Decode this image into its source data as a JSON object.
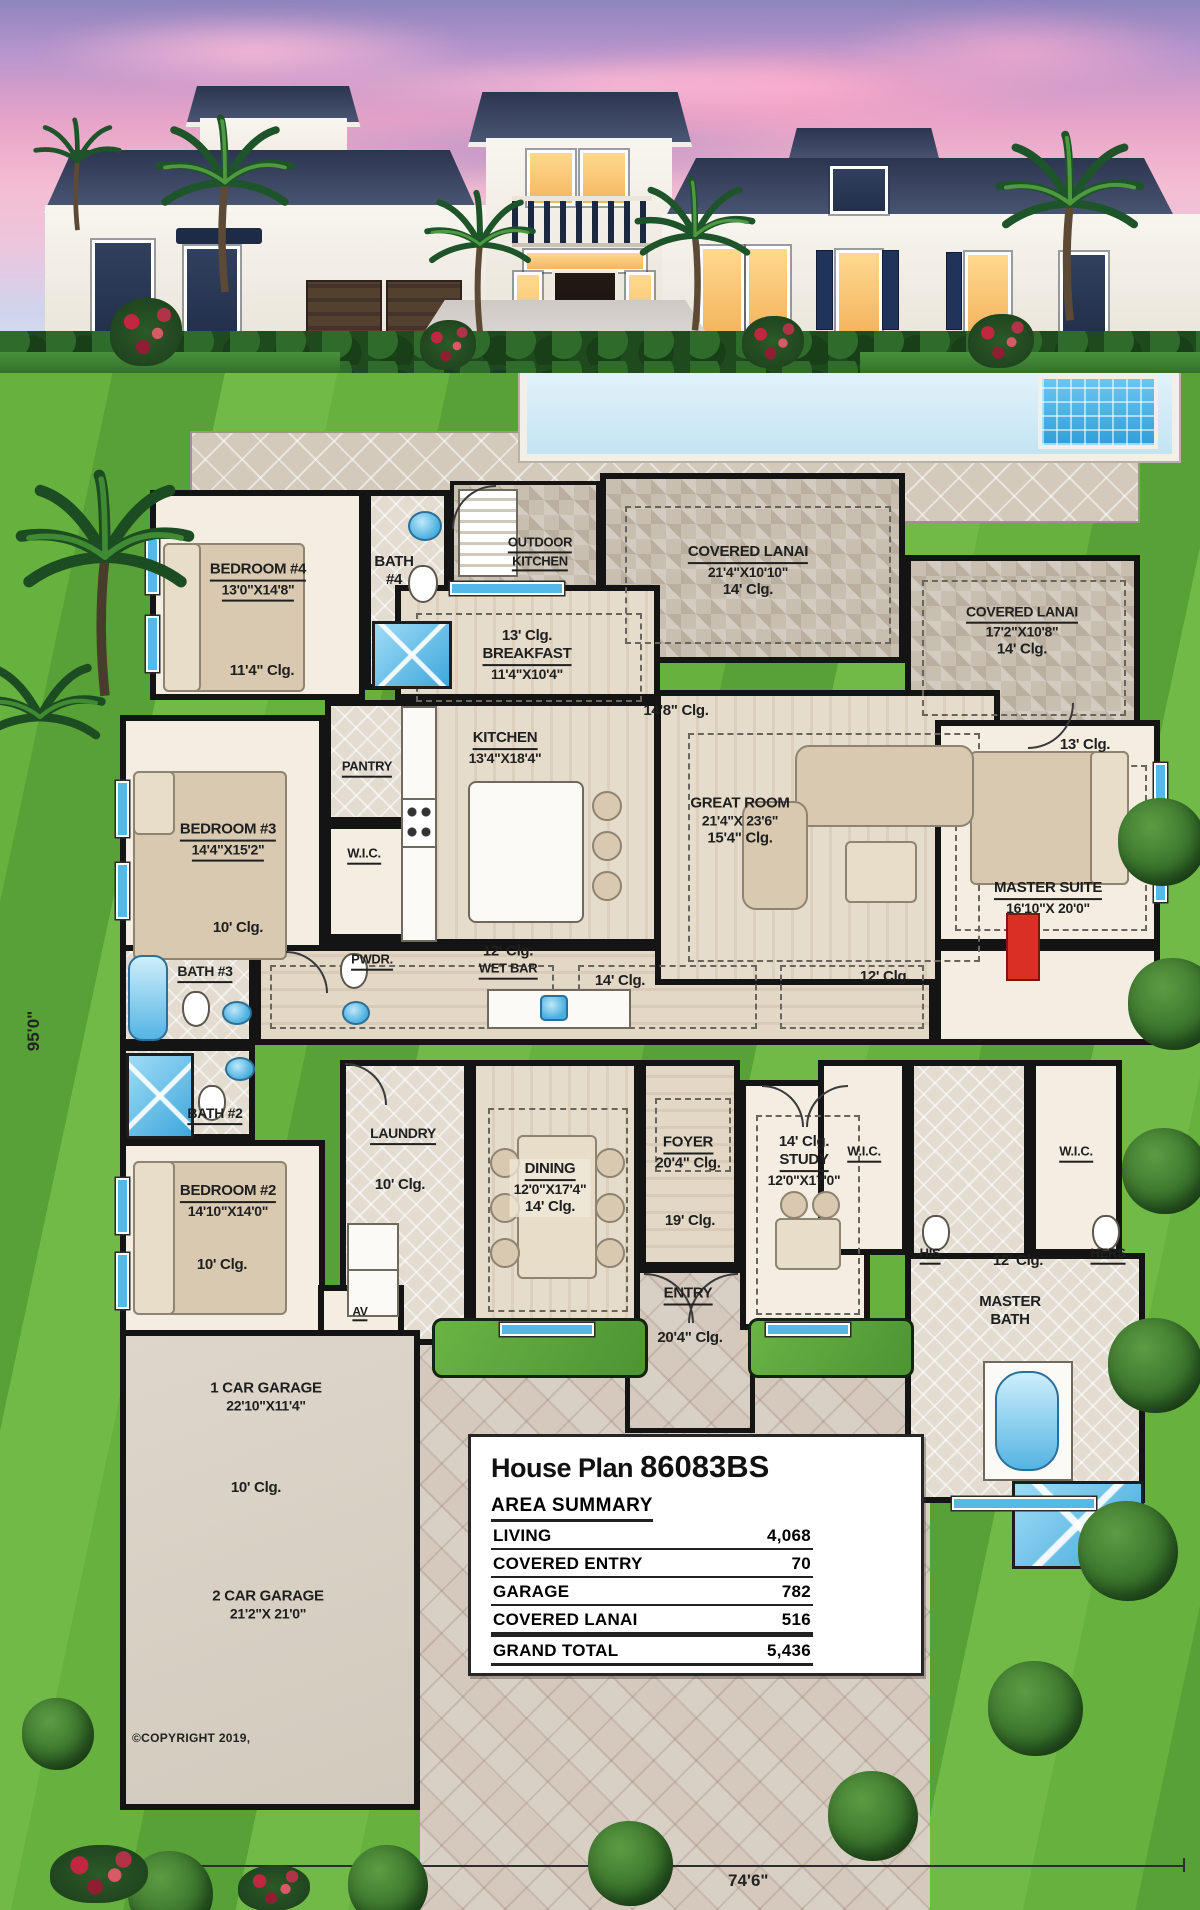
{
  "plan": {
    "dim_left": "95'0\"",
    "dim_bottom": "74'6\"",
    "copyright": "©COPYRIGHT 2019,",
    "rooms": {
      "bedroom4": {
        "name": "BEDROOM #4",
        "size": "13'0\"X14'8\"",
        "clg": "11'4\" Clg."
      },
      "bath4": {
        "l1": "BATH",
        "l2": "#4"
      },
      "outdoor_kitchen": {
        "l1": "OUTDOOR",
        "l2": "KITCHEN"
      },
      "lanai_center": {
        "name": "COVERED LANAI",
        "size": "21'4\"X10'10\"",
        "clg": "14' Clg."
      },
      "lanai_right": {
        "name": "COVERED LANAI",
        "size": "17'2\"X10'8\"",
        "clg": "14' Clg."
      },
      "breakfast": {
        "clg": "13' Clg.",
        "name": "BREAKFAST",
        "size": "11'4\"X10'4\""
      },
      "kitchen": {
        "name": "KITCHEN",
        "size": "13'4\"X18'4\""
      },
      "pantry": {
        "name": "PANTRY"
      },
      "wic_bed3": {
        "name": "W.I.C."
      },
      "bedroom3": {
        "name": "BEDROOM #3",
        "size": "14'4\"X15'2\"",
        "clg": "10' Clg."
      },
      "pwdr": {
        "name": "PWDR."
      },
      "great_room": {
        "clg_upper": "14'8\" Clg.",
        "name": "GREAT ROOM",
        "size": "21'4\"X 23'6\"",
        "clg": "15'4\" Clg."
      },
      "master_suite": {
        "clg": "13' Clg.",
        "name": "MASTER SUITE",
        "size": "16'10\"X 20'0\""
      },
      "wet_bar": {
        "clg": "12' Clg.",
        "name": "WET BAR"
      },
      "hall": {
        "clg14": "14' Clg.",
        "clg12": "12' Clg."
      },
      "bath3": {
        "name": "BATH #3"
      },
      "bath2": {
        "name": "BATH #2"
      },
      "bedroom2": {
        "name": "BEDROOM #2",
        "size": "14'10\"X14'0\"",
        "clg": "10' Clg."
      },
      "laundry": {
        "name": "LAUNDRY",
        "clg": "10' Clg."
      },
      "dining": {
        "name": "DINING",
        "size": "12'0\"X17'4\"",
        "clg": "14' Clg."
      },
      "foyer": {
        "name": "FOYER",
        "clg": "20'4\" Clg.",
        "clg2": "19' Clg."
      },
      "study": {
        "clg": "14' Clg.",
        "name": "STUDY",
        "size": "12'0\"X17'0\""
      },
      "wic_his": {
        "name": "W.I.C."
      },
      "wic_hers": {
        "name": "W.I.C."
      },
      "his_hers": {
        "his": "HIS",
        "hers": "HERS",
        "clg": "12' Clg."
      },
      "master_bath": {
        "l1": "MASTER",
        "l2": "BATH"
      },
      "entry": {
        "name": "ENTRY",
        "clg": "20'4\" Clg."
      },
      "av": {
        "name": "AV"
      },
      "garage1": {
        "name": "1 CAR GARAGE",
        "size": "22'10\"X11'4\""
      },
      "garage": {
        "clg": "10' Clg."
      },
      "garage2": {
        "name": "2 CAR GARAGE",
        "size": "21'2\"X 21'0\""
      }
    },
    "title_block": {
      "prefix": "House Plan",
      "number": "86083BS",
      "heading": "AREA SUMMARY",
      "rows": [
        {
          "label": "LIVING",
          "value": "4,068"
        },
        {
          "label": "COVERED ENTRY",
          "value": "70"
        },
        {
          "label": "GARAGE",
          "value": "782"
        },
        {
          "label": "COVERED LANAI",
          "value": "516"
        },
        {
          "label": "GRAND TOTAL",
          "value": "5,436"
        }
      ]
    }
  }
}
